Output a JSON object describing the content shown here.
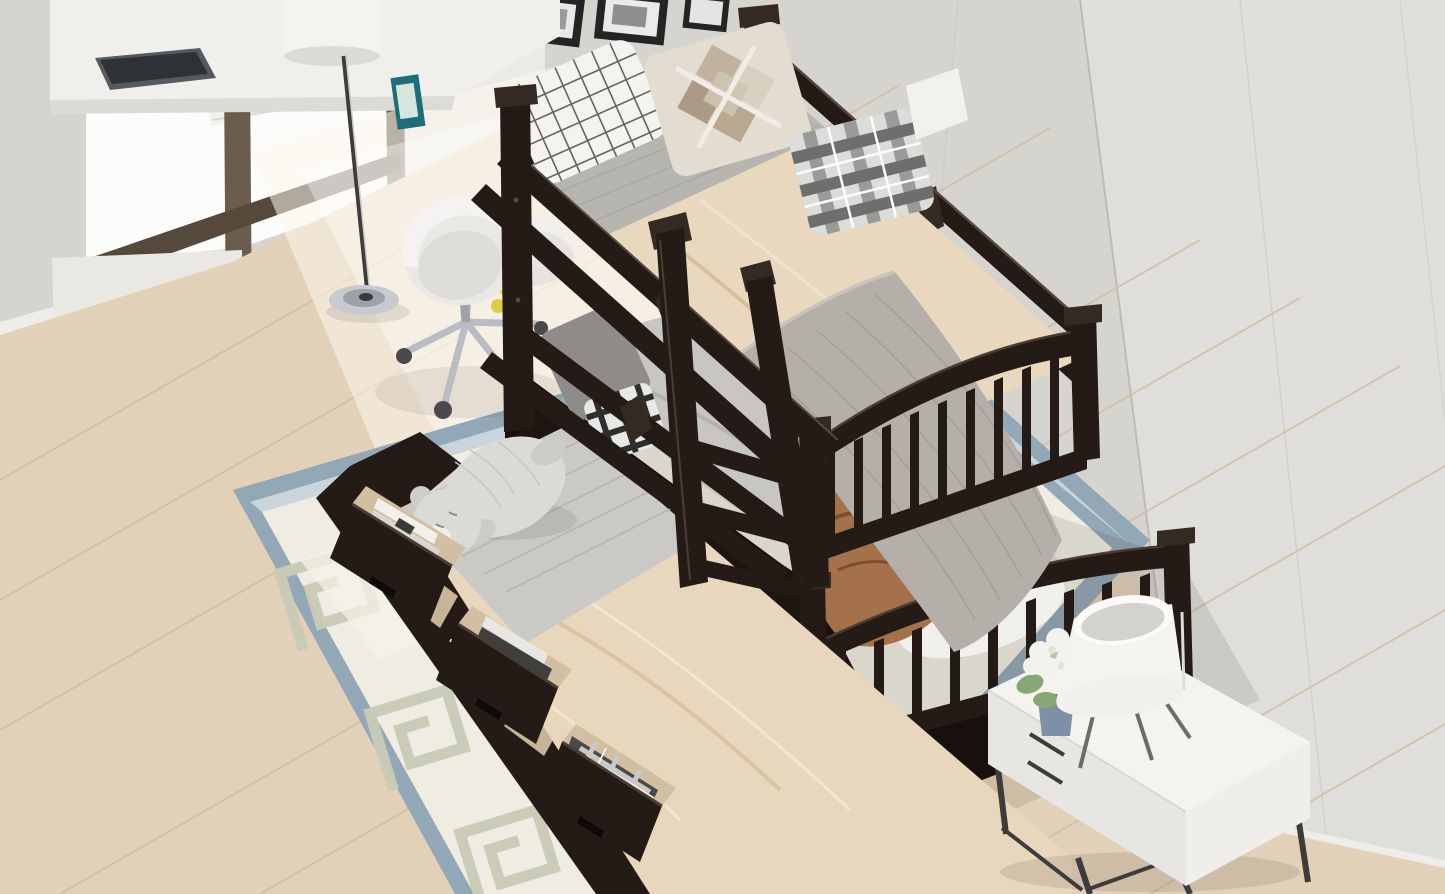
{
  "scene": {
    "description": "Product photograph of an espresso twin-over-twin bunk bed with pull-out trundle and three open storage drawers, staged in a bright bedroom",
    "room": {
      "window": {
        "label": "window with white cellular blinds",
        "blind_color": "#f3f2ef",
        "frame_color": "#6b5d4e"
      },
      "wall_left": {
        "label": "paneled wall behind bed",
        "color": "#d6d4cf"
      },
      "wall_right": {
        "label": "right side wall",
        "color": "#e0deda"
      },
      "baseboard": {
        "color": "#efede9"
      },
      "floor": {
        "label": "light oak plank floor",
        "color": "#e3d0b8",
        "seam_color": "#d2bca0"
      },
      "rug": {
        "label": "greek-key area rug",
        "band_color": "#93a8b7",
        "field_color": "#efede2",
        "pattern_color": "#c9cbb6"
      },
      "wall_art": {
        "label": "three black picture frames",
        "frame_color": "#242424",
        "mat_color": "#e8e8e6"
      }
    },
    "furniture": {
      "bunk_bed": {
        "label": "twin over twin bunk bed with slatted footboards",
        "wood_color": "#241b16",
        "wood_highlight": "#4a3c32",
        "spindles_per_footboard": 9,
        "guardrails": "double horizontal rails on both long sides"
      },
      "ladder": {
        "label": "hook-on access ladder",
        "rungs_visible": 3
      },
      "trundle": {
        "label": "pull-out trundle bed with storage drawers",
        "drawer_count": 3,
        "drawer_face_color": "#241b16",
        "drawer_interior_color": "#d2bfa2",
        "drawer_contents": [
          "magazines and books",
          "stacked books",
          "folded plaid blanket"
        ]
      },
      "nightstand": {
        "label": "white two-drawer nightstand on metal legs",
        "body_color": "#f4f3f0",
        "leg_color": "#3c3c3a"
      },
      "desk": {
        "label": "white desk by window with laptop",
        "color": "#f1efec"
      },
      "office_chair": {
        "label": "white swivel desk chair",
        "shell_color": "#e9e8e5",
        "base_color": "#b9bcc2"
      },
      "floor_lamp": {
        "label": "floor lamp with white drum shade",
        "shade_color": "#f4f3f0",
        "base_color": "#c7cacf"
      },
      "table_lamp": {
        "label": "white tripod table lamp",
        "shade_color": "#f6f5f2"
      },
      "plant": {
        "label": "white hydrangea in blue-gray pot",
        "flower_color": "#f2f3ee",
        "leaf_color": "#86a875",
        "pot_color": "#7e90a5"
      },
      "stool": {
        "label": "small round white side table with yellow flowers"
      }
    },
    "bedding": {
      "top_bunk": {
        "sheet_color": "#e9d8be",
        "mattress_head_color": "#b7b5b0",
        "pillows": [
          "white windowpane-grid pillow",
          "tan patchwork diamond pillow",
          "gray plaid pillow",
          "white pillow"
        ],
        "blanket": {
          "label": "gray knit throw at foot",
          "color": "#b4b0a9"
        }
      },
      "lower_bunk": {
        "sheet_color": "#c7c6c3",
        "pillows": [
          "dark gray pillow",
          "small black-white check cushion",
          "white pillow"
        ],
        "blanket": {
          "label": "copper satin throw",
          "color": "#a5714a"
        }
      },
      "trundle": {
        "sheet_color": "#e8d7bd",
        "blanket": {
          "label": "gray striped blanket",
          "color": "#cac9c5"
        },
        "plush": {
          "label": "sleeping teddy bear plush",
          "color": "#dadad6"
        }
      }
    },
    "palette": {
      "espresso": "#241b16",
      "espresso_hi": "#4a3c32",
      "wall_left": "#d6d4cf",
      "wall_right": "#e0deda",
      "floor": "#e3d0b8",
      "rug_band": "#93a8b7",
      "rug_field": "#efede2",
      "rug_pattern": "#c9cbb6",
      "sheet_beige": "#e9d8be",
      "sheet_gray": "#c7c6c3",
      "trundle_sheet": "#e8d7bd",
      "knit_gray": "#b4b0a9",
      "copper": "#a5714a",
      "bear": "#dadad6",
      "nightstand": "#f4f3f0",
      "chrome": "#b9bcc2"
    }
  }
}
